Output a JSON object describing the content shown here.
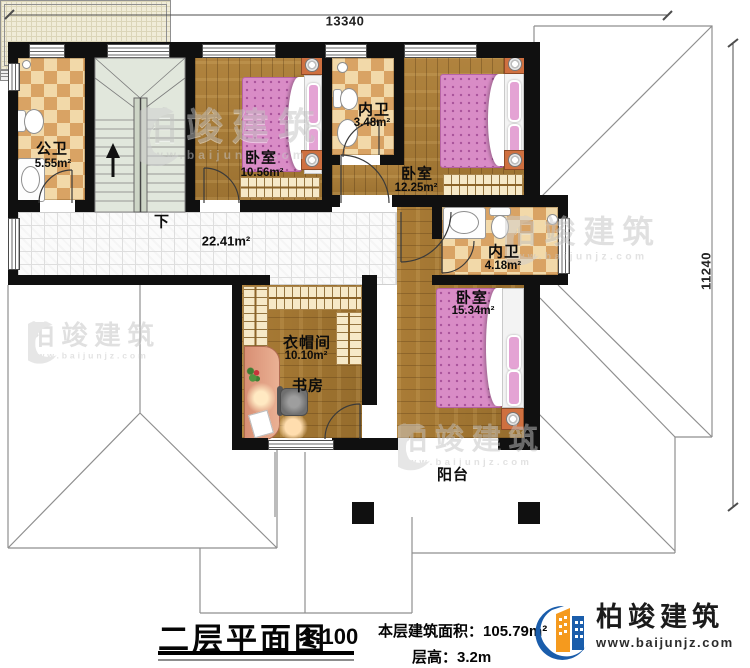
{
  "dimensions": {
    "width_mm": "13340",
    "height_mm": "11240"
  },
  "stairs": {
    "down_label": "下"
  },
  "rooms": {
    "public_bath": {
      "name": "公卫",
      "area": "5.55m²"
    },
    "bedroom_nw": {
      "name": "卧室",
      "area": "10.56m²"
    },
    "inner_bath_top": {
      "name": "内卫",
      "area": "3.48m²"
    },
    "bedroom_ne": {
      "name": "卧室",
      "area": "12.25m²"
    },
    "hallway": {
      "area": "22.41m²"
    },
    "inner_bath_mid": {
      "name": "内卫",
      "area": "4.18m²"
    },
    "bedroom_s": {
      "name": "卧室",
      "area": "15.34m²"
    },
    "cloakroom": {
      "name": "衣帽间",
      "area": "10.10m²"
    },
    "study": {
      "name": "书房"
    },
    "balcony": {
      "name": "阳台"
    }
  },
  "title": {
    "name": "二层平面图",
    "scale": "1:100"
  },
  "stats": {
    "floor_area_label": "本层建筑面积：",
    "floor_area_value": "105.79m²",
    "floor_height_label": "层高：",
    "floor_height_value": "3.2m"
  },
  "brand": {
    "name": "柏竣建筑",
    "website": "www.baijunjz.com"
  },
  "watermark": {
    "name": "柏竣建筑",
    "website": "www.baijunjz.com"
  },
  "colors": {
    "wall": "#101010",
    "wood": "#a87d3a",
    "tile_dark": "#d9a364",
    "bed_pink": "#d98cc6",
    "brand_blue": "#1a5dab",
    "brand_orange": "#f59a1e"
  }
}
